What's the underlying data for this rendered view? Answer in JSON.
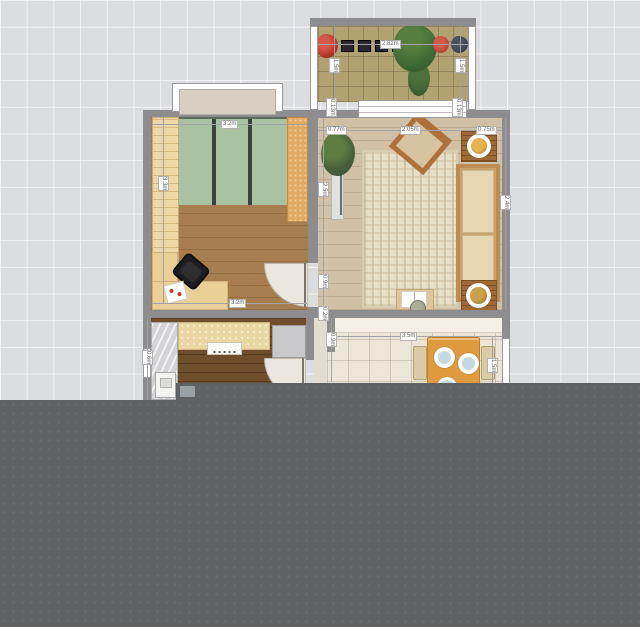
{
  "view": {
    "type": "floor-plan-2d",
    "grid_visible": true
  },
  "dimensions": {
    "bedroom_top": "3.2m",
    "bedroom_bottom": "3.2m",
    "bedroom_left": "3.3m",
    "balcony_width": "2.82m",
    "balcony_left": "1.5m",
    "balcony_right": "1.5m",
    "window_left_end": "0.13m",
    "window_right_end": "0.13m",
    "living_top_left": "0.77m",
    "living_top_mid": "2.05m",
    "living_top_right": "0.75m",
    "living_left": "2.5m",
    "living_right": "2.4m",
    "door_width": "0.9m",
    "wall_gap": "0.2m",
    "hall_top": "0.9m",
    "dining_width": "3.5m",
    "dining_right": "1.5m",
    "kitchen_left": "0.6m"
  },
  "palette": {
    "grid_background": "#dcdde0",
    "wall": "#8d8d8f",
    "bedroom_floor": "#a87e50",
    "living_floor": "#cfc0a6",
    "kitchen_floor": "#6f4e2c",
    "balcony_tile": "#b2a272",
    "dining_tile": "#ece6d8",
    "rug": "#e7dec6",
    "wardrobe_green": "#a9c2a2",
    "counter_beige": "#ead7a3",
    "dining_table_orange": "#e09a3e",
    "overlay_gray": "#5f6163"
  },
  "rooms": [
    "bedroom",
    "living-room",
    "balcony",
    "kitchen",
    "hallway",
    "dining-area"
  ],
  "furniture": [
    "wardrobe",
    "tall-cabinet",
    "desk",
    "office-chair",
    "papers",
    "bedroom-door",
    "kitchen-door",
    "bay-window",
    "potted-plant-living",
    "tv-console",
    "armchair",
    "sofa",
    "side-table-top",
    "side-table-bottom",
    "coffee-table",
    "open-book",
    "vase",
    "balcony-plant-red-left",
    "balcony-planter-row",
    "balcony-plant-green",
    "balcony-plant-red-right",
    "balcony-pot-dark",
    "kitchen-counter",
    "stove",
    "sink-unit",
    "fridge-marble",
    "washing-machine",
    "dining-table",
    "dinner-plate-1",
    "dinner-plate-2",
    "dinner-plate-3",
    "dining-chair-left",
    "dining-chair-right"
  ]
}
